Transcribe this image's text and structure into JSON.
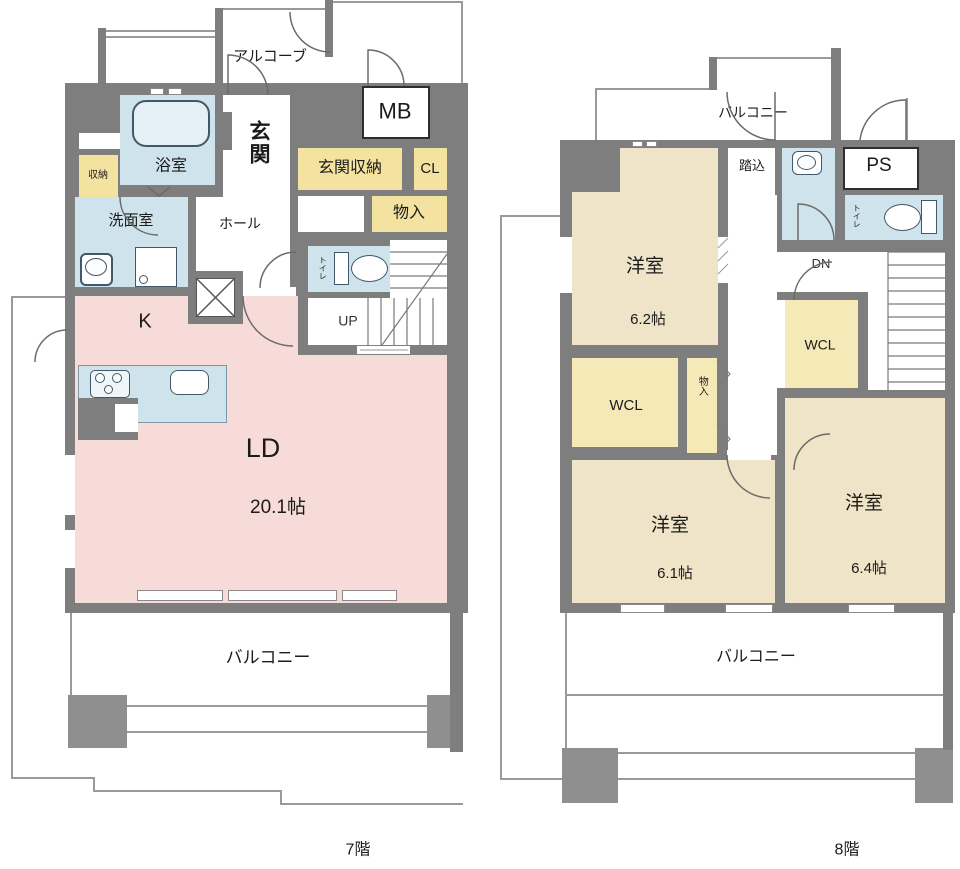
{
  "page_title": "マンション間取り図（メゾネット 7階・8階）",
  "colors": {
    "wall": "#7e7e7e",
    "pillar": "#8f8f8f",
    "outline": "#9a9a9a",
    "ldk_pink": "#f7dbd8",
    "water_blue": "#cfe3ec",
    "storage_yellow": "#f4e2a0",
    "wcl_yellow": "#f6e9b8",
    "bedroom_beige": "#f0e4c8",
    "icon_stroke": "#41586b"
  },
  "floor7": {
    "floor_label": "7階",
    "rooms": {
      "alcove": "アルコーブ",
      "mb": "MB",
      "genkan": "玄関",
      "genkan_storage": "玄関収納",
      "cl": "CL",
      "monoire": "物入",
      "bathroom": "浴室",
      "storage": "収納",
      "washroom": "洗面室",
      "hall": "ホール",
      "toilet": "トイレ",
      "stairs": "UP",
      "kitchen": "K",
      "living_dining": "LD",
      "living_dining_size": "20.1帖",
      "balcony": "バルコニー"
    }
  },
  "floor8": {
    "floor_label": "8階",
    "rooms": {
      "balcony_top": "バルコニー",
      "fumikomi": "踏込",
      "ps": "PS",
      "toilet": "トイレ",
      "stairs": "DN",
      "bedroom1": "洋室",
      "bedroom1_size": "6.2帖",
      "wcl_left": "WCL",
      "monoire": "物入",
      "wcl_right": "WCL",
      "bedroom2": "洋室",
      "bedroom2_size": "6.1帖",
      "bedroom3": "洋室",
      "bedroom3_size": "6.4帖",
      "balcony_bottom": "バルコニー"
    }
  }
}
